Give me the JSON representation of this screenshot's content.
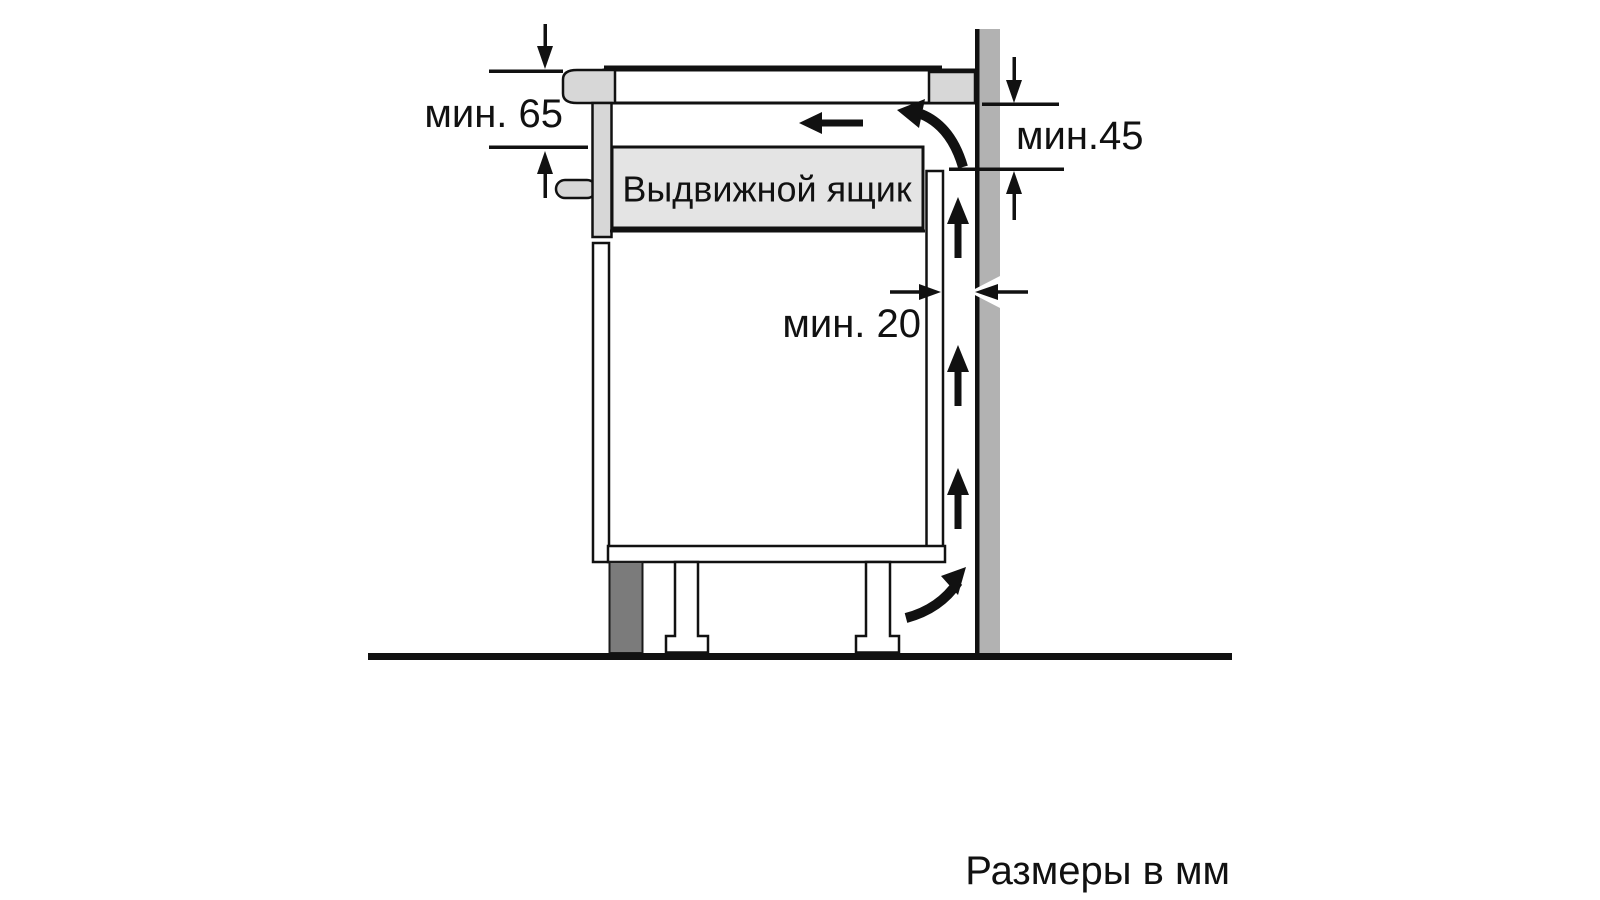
{
  "diagram": {
    "drawer_label": "Выдвижной ящик",
    "dim_min_65": "мин. 65",
    "dim_min_45": "мин.45",
    "dim_min_20": "мин. 20",
    "units_note": "Размеры в мм",
    "colors": {
      "line": "#111111",
      "component_gray": "#d7d7d7",
      "drawer_gray": "#e4e4e4",
      "wall_gray": "#b2b2b2",
      "plinth_gray": "#7b7b7b"
    }
  }
}
